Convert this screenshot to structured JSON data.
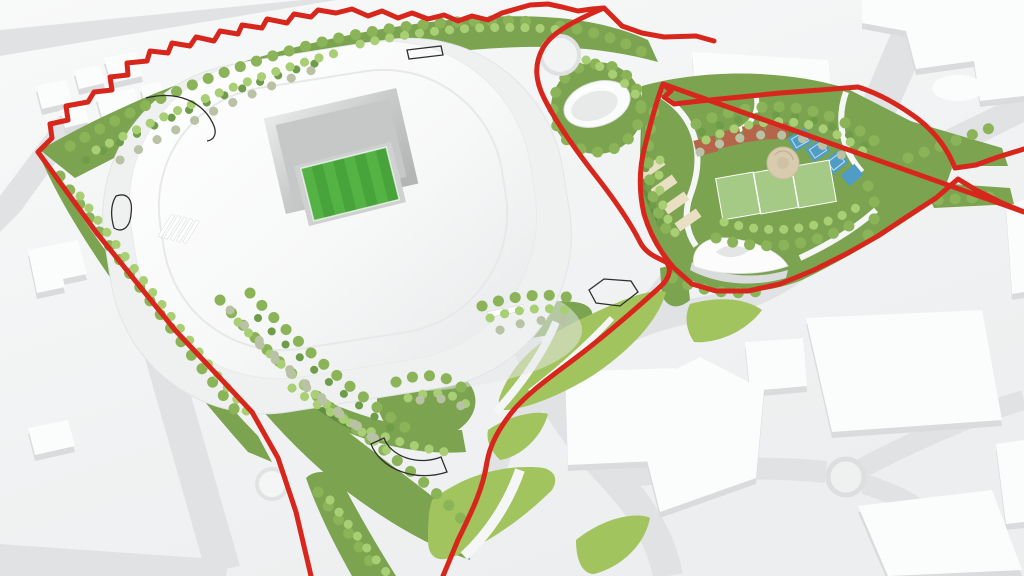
{
  "scene": {
    "aria_label": "3D aerial masterplan rendering of a stadium development site outlined by a red boundary line, with landscaped parkland, an amphitheatre mound, sports courts and surrounding white city blocks",
    "colors": {
      "bg_top": "#f7f8f8",
      "bg_bottom": "#edeff0",
      "road": "#e0e2e4",
      "building_top": "#fbfcfc",
      "building_side": "#d9dbdc",
      "boundary_red": "#d7271c",
      "green_base": "#7ba350",
      "green_dark": "#5f8a3e",
      "green_lawn": "#a2c45e",
      "tree_mid": "#8ab457",
      "tree_light": "#a9cf74",
      "tree_grey": "#b9c2a5",
      "tree_dark": "#6f9c49",
      "pitch_green": "#47a33a",
      "pitch_stripe": "#55b244",
      "bowl_grey": "#c6c8c8",
      "roof_white": "#fdfdfd",
      "court_clay": "#b5664a",
      "court_blue": "#4f9dc6",
      "court_sand": "#e9dfc2",
      "plaza_beige": "#d8cbae",
      "sports_pitch": "#a5ca86",
      "outline_black": "#2f2f2f",
      "path_white": "#f5f6f6"
    }
  }
}
